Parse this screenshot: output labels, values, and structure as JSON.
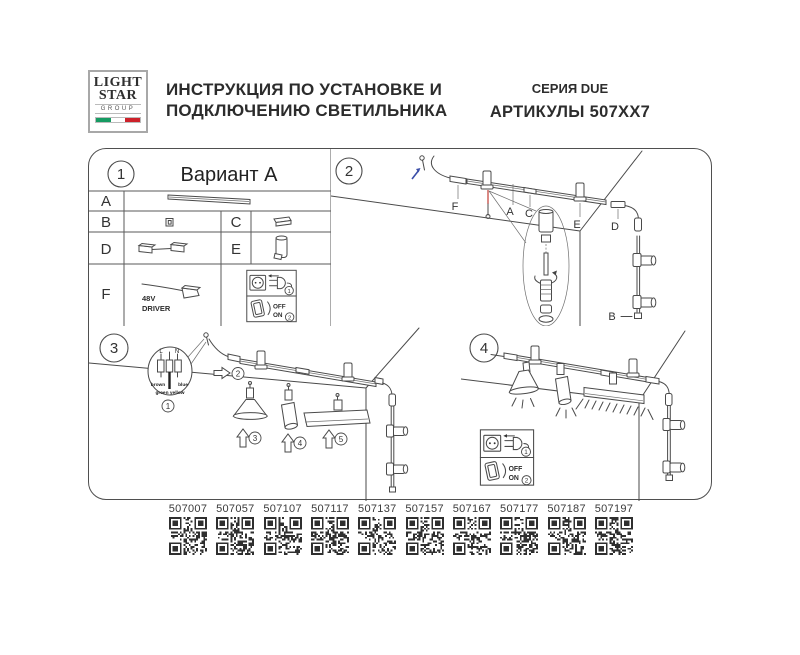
{
  "header": {
    "logo": {
      "line1": "LIGHT",
      "line2": "STAR",
      "line3": "GROUP"
    },
    "title_line1": "ИНСТРУКЦИЯ ПО УСТАНОВКЕ И",
    "title_line2": "ПОДКЛЮЧЕНИЮ СВЕТИЛЬНИКА",
    "series": "СЕРИЯ DUE",
    "articles": "АРТИКУЛЫ 507XX7"
  },
  "panel1": {
    "number": "1",
    "title": "Вариант А",
    "labels": {
      "a": "A",
      "b": "B",
      "c": "C",
      "d": "D",
      "e": "E",
      "f": "F"
    },
    "driver": {
      "line1": "48V",
      "line2": "DRIVER"
    }
  },
  "panel2": {
    "number": "2",
    "labels": {
      "f": "F",
      "a": "A",
      "c": "C",
      "e": "E",
      "d": "D",
      "b": "B"
    }
  },
  "panel3": {
    "number": "3",
    "steps": {
      "s1": "1",
      "s2": "2",
      "s3": "3",
      "s4": "4",
      "s5": "5"
    },
    "wire": {
      "l": "L",
      "n": "N",
      "left": "brown",
      "right": "blue",
      "bottom": "green yellow"
    }
  },
  "panel4": {
    "number": "4"
  },
  "power_box": {
    "step1": "1",
    "step2": "2",
    "off": "OFF",
    "on": "ON"
  },
  "qr": {
    "items": [
      {
        "code": "507007"
      },
      {
        "code": "507057"
      },
      {
        "code": "507107"
      },
      {
        "code": "507117"
      },
      {
        "code": "507137"
      },
      {
        "code": "507157"
      },
      {
        "code": "507167"
      },
      {
        "code": "507177"
      },
      {
        "code": "507187"
      },
      {
        "code": "507197"
      }
    ]
  },
  "colors": {
    "line": "#4a4a4a",
    "suspension_red": "#c23b33",
    "arrow_blue": "#3b4ea8",
    "flag_green": "#169b62",
    "flag_red": "#cd212a"
  }
}
